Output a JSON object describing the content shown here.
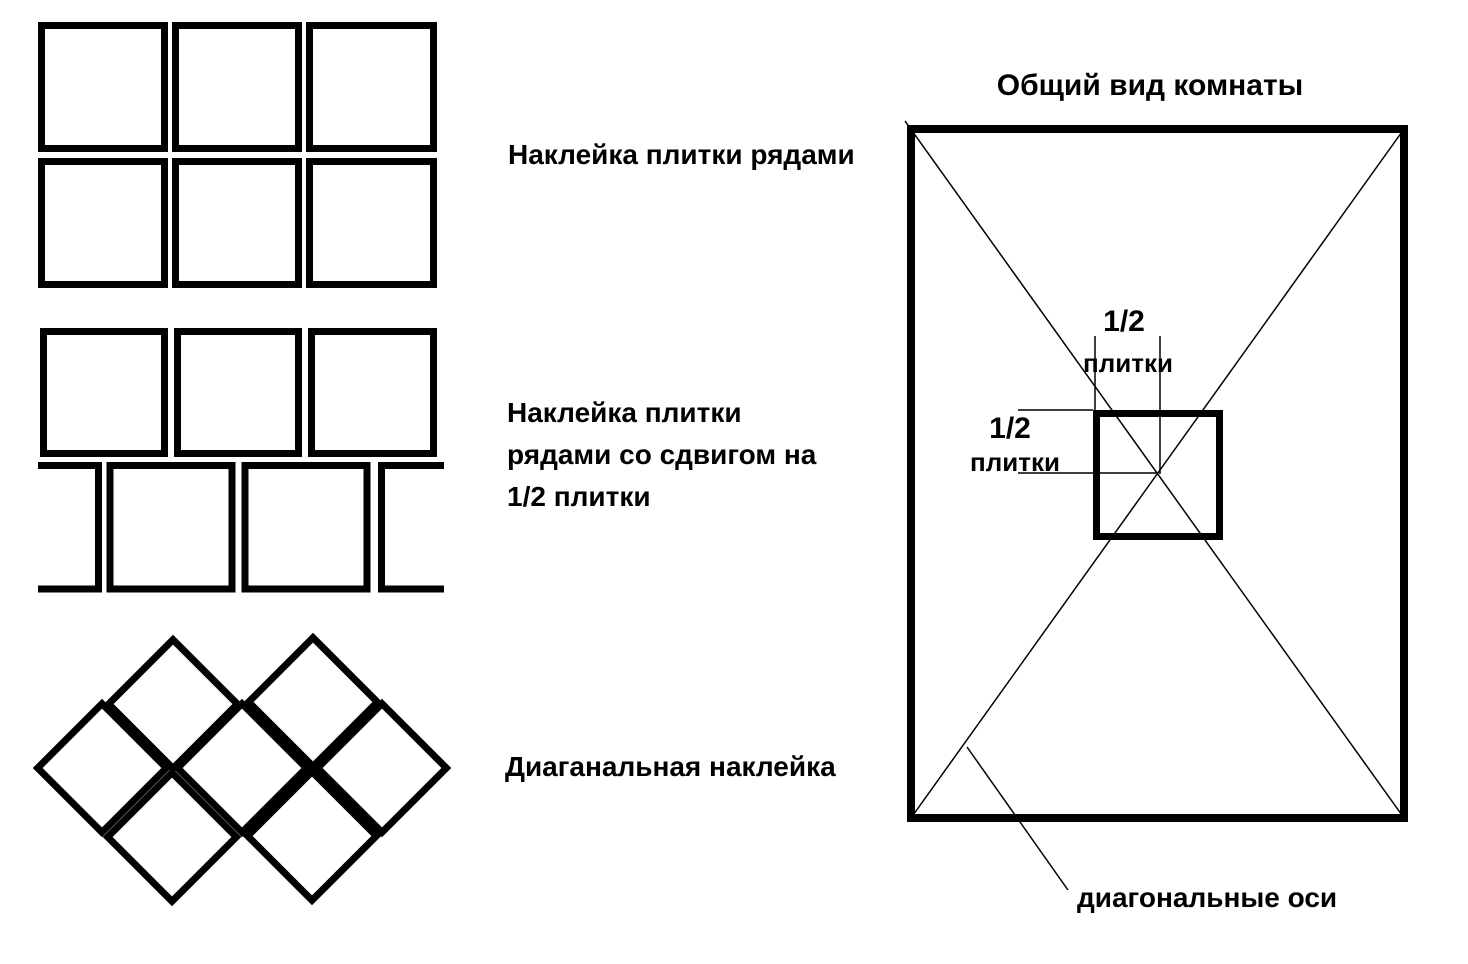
{
  "page": {
    "background_color": "#ffffff",
    "ink_color": "#000000"
  },
  "patterns": [
    {
      "name": "rows",
      "label": "Наклейка плитки рядами"
    },
    {
      "name": "rows-offset-half",
      "label_lines": [
        "Наклейка плитки",
        "рядами со сдвигом на",
        "1/2 плитки"
      ]
    },
    {
      "name": "diagonal",
      "label": "Диаганальная наклейка"
    }
  ],
  "room": {
    "title": "Общий вид комнаты",
    "half_tile_top": [
      "1/2",
      "плитки"
    ],
    "half_tile_left": [
      "1/2",
      "плитки"
    ],
    "diagonal_axes_label": "диагональные оси"
  }
}
